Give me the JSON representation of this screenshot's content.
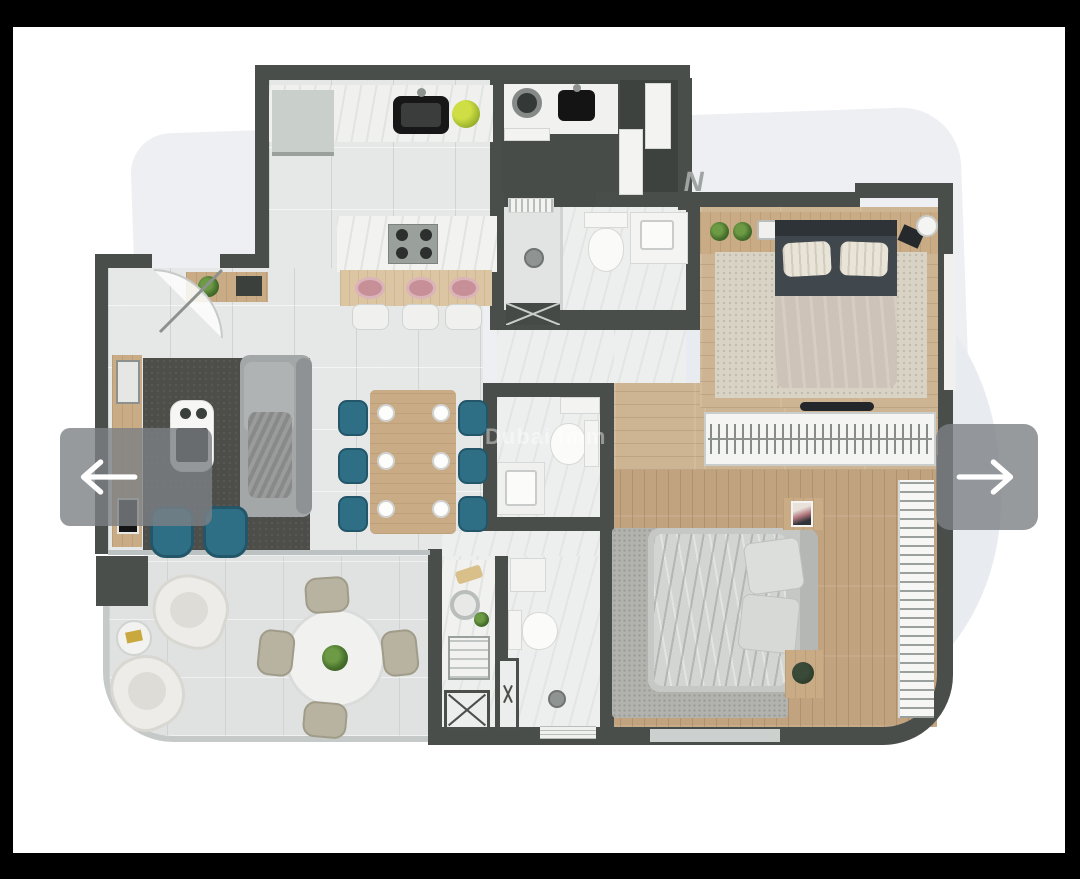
{
  "viewer": {
    "watermark_text": "Dubai Imm",
    "brand_mark": "N",
    "nav": {
      "prev_icon": "arrow-left-icon",
      "next_icon": "arrow-right-icon"
    }
  },
  "colors": {
    "frame": "#000000",
    "page": "#ffffff",
    "shadow": "#e9ecef",
    "wall": "#4a4e4b",
    "tile_floor": "#e6e8e7",
    "marble_floor": "#edefee",
    "wood_bedroom_1": "#cdb492",
    "wood_bedroom_2": "#c2a37f",
    "terrace_floor": "#e0e2e1",
    "living_rug": "#4d4e49",
    "bedroom_1_rug": "#d8d3c4",
    "bedroom_2_rug": "#b2b2ae",
    "teal_chairs": "#2f6f86",
    "pink_plates": "#c79098",
    "greenery": "#4e7d33",
    "nav_overlay": "rgba(125,129,132,0.8)",
    "watermark": "rgba(255,255,255,0.42)"
  },
  "floor_plan": {
    "rooms": [
      "kitchen",
      "laundry",
      "storage-closet",
      "bathroom-1",
      "bathroom-2",
      "powder-room",
      "wc-shower-room",
      "living-room",
      "dining-area",
      "hallway",
      "bedroom-1",
      "walk-in-wardrobe",
      "bedroom-2",
      "terrace"
    ],
    "furniture": [
      "kitchen-counter",
      "kitchen-island",
      "gas-hob",
      "black-sink",
      "washing-machine",
      "fruit-bowl",
      "bar-stools",
      "dining-table",
      "teal-dining-chairs",
      "gray-sofa",
      "coffee-table",
      "tv-console",
      "teal-armchairs",
      "entry-door",
      "double-bed-dark",
      "double-bed-gray",
      "headboard-shelf",
      "wardrobe-rail",
      "curtain-wall",
      "toilet",
      "washbasin",
      "shower",
      "round-terrace-table",
      "wicker-chairs",
      "curved-terrace-sofas",
      "side-table"
    ]
  }
}
